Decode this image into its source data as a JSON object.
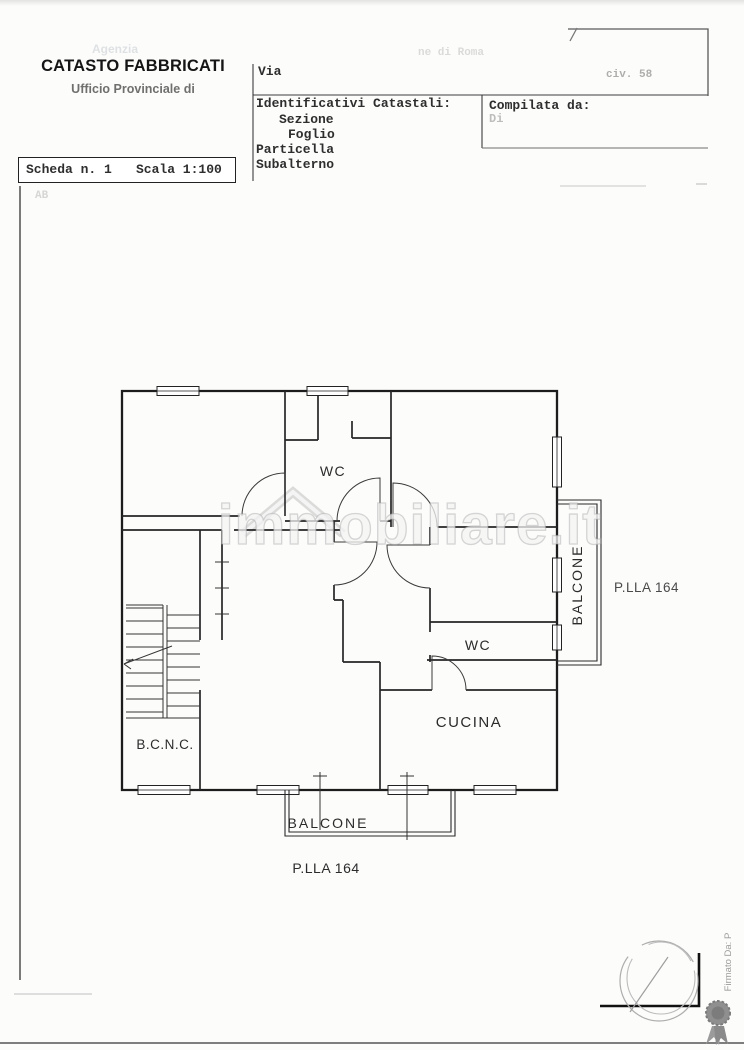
{
  "header": {
    "title": "CATASTO FABBRICATI",
    "subtitle": "Ufficio Provinciale di",
    "agency_faded": "Agenzia",
    "via_label": "Via",
    "comune_faded": "ne di Roma",
    "civ_faded": "civ. 58",
    "identificativi_label": "Identificativi Catastali:",
    "sezione_label": "Sezione",
    "foglio_label": "Foglio",
    "particella_label": "Particella",
    "subalterno_label": "Subalterno",
    "compilata_label": "Compilata da:",
    "compilata_faded": "Di"
  },
  "scheda": {
    "number_label": "Scheda n. 1",
    "scale_label": "Scala 1:100",
    "note_faded": "AB"
  },
  "plan": {
    "labels": {
      "wc_top": "WC",
      "wc_mid": "WC",
      "kitchen": "CUCINA",
      "stairwell": "B.C.N.C.",
      "balcony_bottom": "BALCONE",
      "balcony_right": "BALCONE",
      "parcel_right": "P.LLA 164",
      "parcel_bottom": "P.LLA 164"
    }
  },
  "watermark": {
    "text": "immobiliare.it"
  },
  "footer": {
    "signature_vertical": "Firmato Da: P"
  }
}
